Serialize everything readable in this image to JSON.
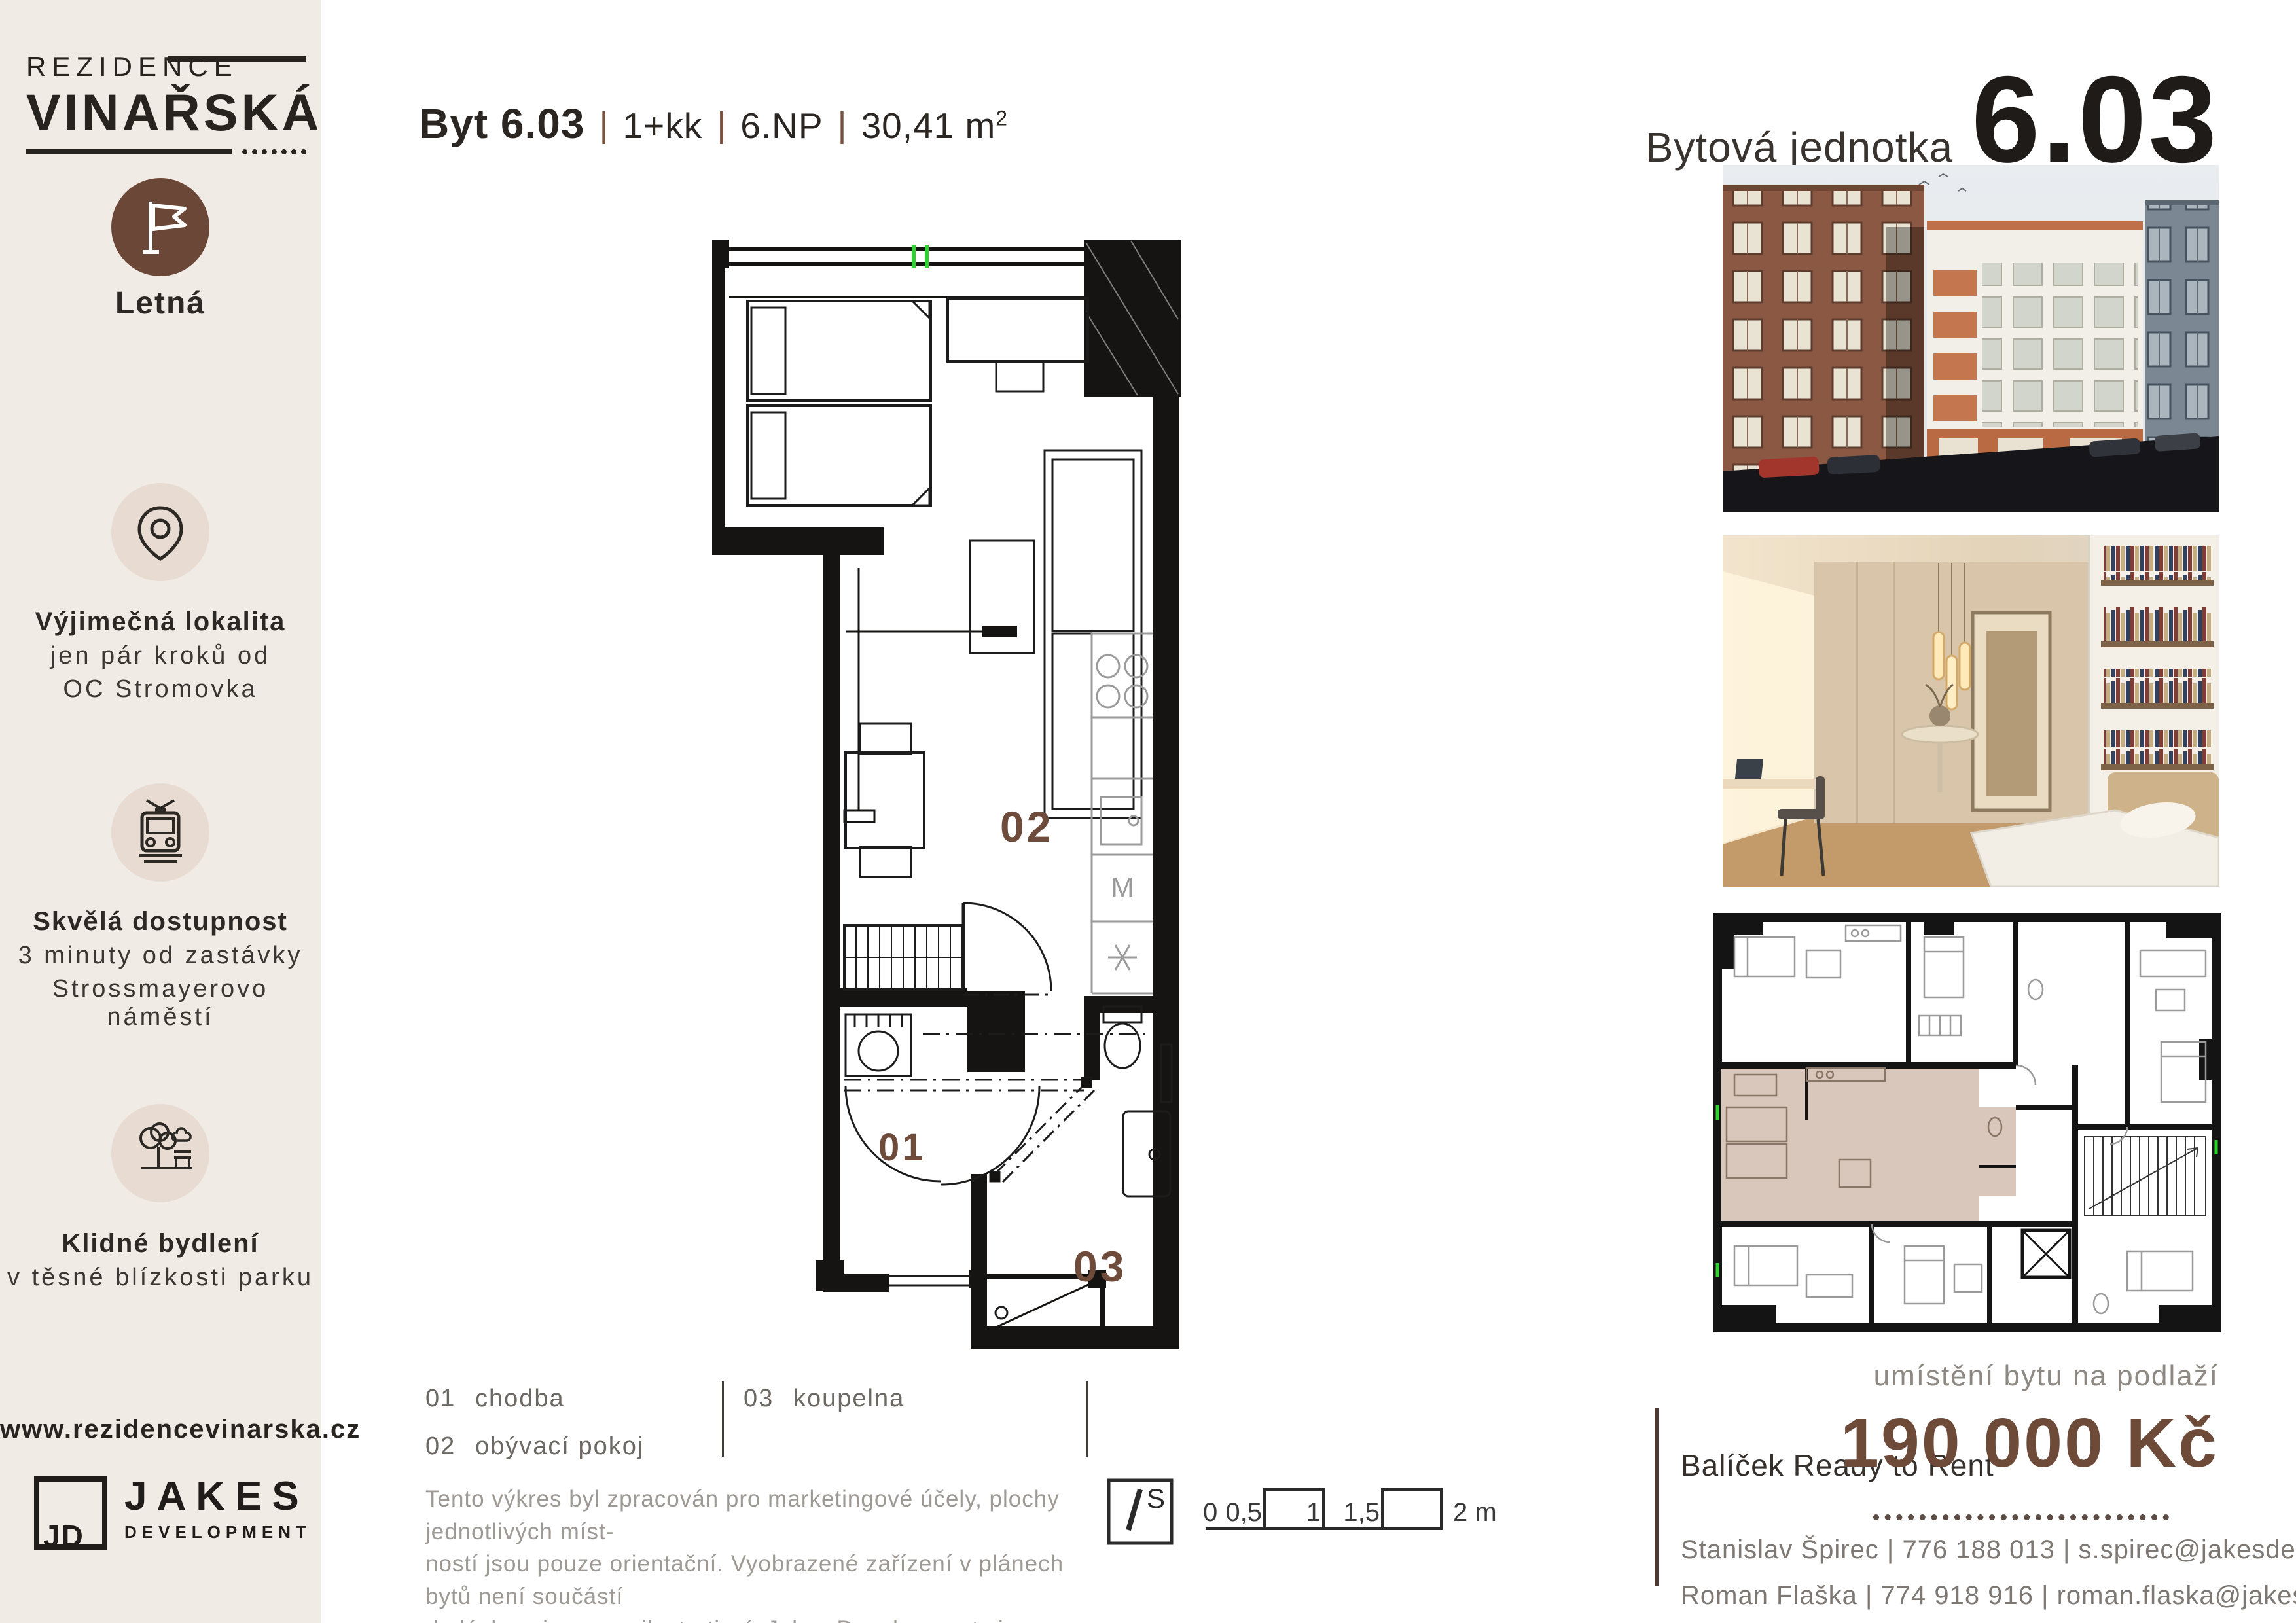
{
  "sidebar": {
    "brand": {
      "line1": "REZIDENCE",
      "line2": "VINAŘSKÁ"
    },
    "features": [
      {
        "icon": "flag-icon",
        "title": "Letná",
        "lines": []
      },
      {
        "icon": "location-pin-icon",
        "title": "Výjimečná lokalita",
        "lines": [
          "jen pár kroků od",
          "OC Stromovka"
        ]
      },
      {
        "icon": "tram-icon",
        "title": "Skvělá dostupnost",
        "lines": [
          "3 minuty od zastávky",
          "Strossmayerovo náměstí"
        ]
      },
      {
        "icon": "park-icon",
        "title": "Klidné bydlení",
        "lines": [
          "v těsné blízkosti parku"
        ]
      }
    ],
    "website": "www.rezidencevinarska.cz",
    "developer": {
      "monogram": "JD",
      "name": "JAKES",
      "subtitle": "DEVELOPMENT"
    }
  },
  "header": {
    "apartment_label": "Byt 6.03",
    "separator": "|",
    "layout": "1+kk",
    "floor": "6.NP",
    "area": "30,41 m",
    "area_sup": "2"
  },
  "unit_panel": {
    "label": "Bytová jednotka",
    "number": "6.03"
  },
  "floor_plan": {
    "label_living": "02",
    "label_hall": "01",
    "label_bath": "03",
    "washer_label": "M"
  },
  "legend": {
    "items": [
      {
        "num": "01",
        "name": "chodba"
      },
      {
        "num": "02",
        "name": "obývací pokoj"
      },
      {
        "num": "03",
        "name": "koupelna"
      }
    ]
  },
  "disclaimer": [
    "Tento výkres byl zpracován pro marketingové účely, plochy jednotlivých míst-",
    "ností jsou pouze orientační. Vyobrazené zařízení v plánech bytů není součástí",
    "dodávky a je pouze ilustrativní. Jakes Development si vyhrazuje právo změny."
  ],
  "compass": {
    "label": "S"
  },
  "scale_bar": {
    "labels": [
      "0",
      "0,5",
      "1",
      "1,5"
    ],
    "end_label": "2 m"
  },
  "location_caption": "umístění bytu na podlaží",
  "offer": {
    "package": "Balíček Ready to Rent",
    "price": "190 000 Kč"
  },
  "contacts_sep": " | ",
  "contacts": [
    {
      "name": "Stanislav Špirec ",
      "phone": "776 188 013",
      "email": "s.spirec@jakesdevelopment.cz"
    },
    {
      "name": "Roman Flaška ",
      "phone": "774 918 916",
      "email": "roman.flaska@jakesdevelopment.cz"
    }
  ],
  "colors": {
    "accent_brown": "#6e4b3a",
    "sidebar_bg": "#f1ebe6",
    "text_dark": "#28241f",
    "text_gray": "#9d9995",
    "highlight_unit": "#d8c7ba",
    "flag_circle": "#6b4737",
    "icon_circle": "#e7dbd2",
    "window_mark_green": "#2fd12f"
  }
}
